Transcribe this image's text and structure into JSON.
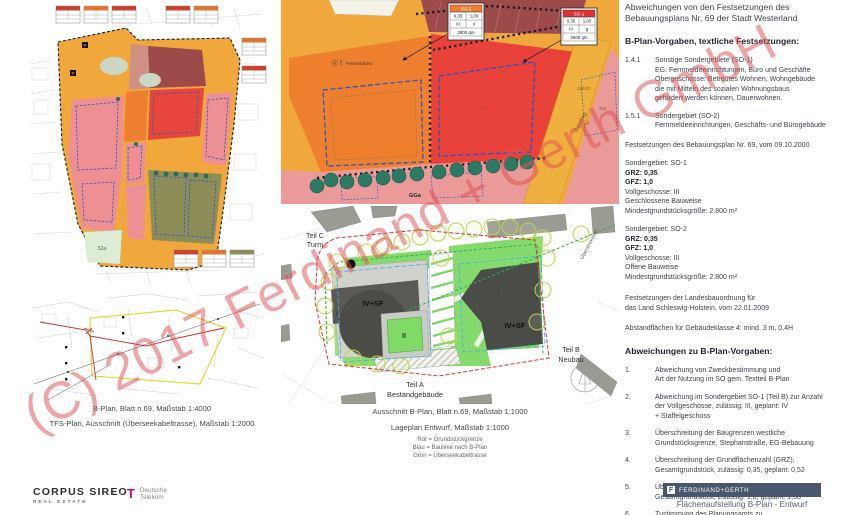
{
  "watermark": "(C) 2017 Ferdinand + Gerth GmbH",
  "colors": {
    "zone_yellow": "#f0a83c",
    "zone_orange": "#ee7f2e",
    "zone_red": "#e8453c",
    "zone_darkred": "#9c4a4a",
    "zone_pink": "#ee9093",
    "zone_olive": "#8d8d5a",
    "tree_teal": "#2c7a63",
    "site_green": "#85da6e",
    "building_gray": "#55554f",
    "dash_red": "#e03030",
    "dash_blue": "#44aaee",
    "dash_green": "#2db04a",
    "logo_bar_blue": "#49566e",
    "telekom_magenta": "#e20074"
  },
  "maps": {
    "overview": {
      "caption": "B-Plan, Blatt n.69, Maßstab 1:4000",
      "label_52a": "52a",
      "p_label": "P"
    },
    "tfs": {
      "caption": "TFS-Plan, Ausschnitt (Überseekabeltrasse), Maßstab 1:2000"
    },
    "detail": {
      "caption": "Ausschnitt B-Plan, Blatt n.69, Maßstab 1:1000",
      "so2_box": {
        "title": "SO-2",
        "r1c1": "0,35",
        "r1c2": "1,00",
        "r2c1": "III",
        "r2c2": "o",
        "r3": "2800 qm"
      },
      "so1_box": {
        "title": "SO-1",
        "r1c1": "0,35",
        "r1c2": "1,00",
        "r2c1": "III",
        "r2c2": "g",
        "r3": "2800 qm"
      },
      "fernsehturm": "Fernsehturm",
      "gga": "GGa",
      "parcel_333": "333",
      "bahnweg": "Bahnweg",
      "parcel_150": "150/22",
      "parcel_344": "344"
    },
    "siteplan": {
      "caption": "Lageplan Entwurf, Maßstab 1:1000",
      "legend": "Rot = Grundstückgrenze\nBlau = Baulinie nach B-Plan\nGrün = Überseekabeltrasse",
      "teil_c1": "Teil C",
      "teil_c2": "Turm",
      "teil_a1": "Teil A",
      "teil_a2": "Bestandgebäude",
      "teil_b1": "Teil B",
      "teil_b2": "Neubau",
      "floors_left": "IV+SF",
      "floors_right": "IV+SF",
      "label_I_left": "I",
      "label_II": "II",
      "label_I_right": "I",
      "cable": "Überseekabel"
    }
  },
  "rp": {
    "title": "Abweichungen von den Festsetzungen des Bebauungsplans Nr. 69 der Stadt Westerland",
    "h1": "B-Plan-Vorgaben, textliche Festsetzungen:",
    "items1": [
      {
        "num": "1.4.1",
        "text": "Sonstige Sondergebiete (SO-1)\nEG: Fernmeldeeinrichtungen, Büro und Geschäfte\nObergeschosse: Betreutes Wohnen, Wohngebäude\ndie mit Mitteln des sozialen Wohnungsbaus\ngefördert werden können, Dauerwohnen."
      },
      {
        "num": "1.5.1",
        "text": "Sondergebiet (SO-2)\nFernmeldeeinrichtungen, Geschäfts- und Bürogebäude"
      }
    ],
    "note1": "Festsetzungen des Bebauungsplan Nr. 69, vom 09.10.2000",
    "so1": {
      "t": "Sondergebiet: SO-1",
      "grz": "GRZ: 0,35",
      "gfz": "GFZ: 1,0",
      "rest": "Vollgeschosse: III\nGeschlossene Bauweise\nMindestgrundstücksgröße: 2.800 m²"
    },
    "so2": {
      "t": "Sondergebiet: SO-2",
      "grz": "GRZ: 0,35",
      "gfz": "GFZ: 1,0",
      "rest": "Vollgeschosse: III\nOffene Bauweise\nMindestgrundstücksgröße: 2.800 m²"
    },
    "note2": "Festsetzungen der Landesbauordnung für\ndas Land Schleswig-Holstein, vom 22.01.2009",
    "note3": "Abstandflächen für Gebäudeklasse 4: mind. 3 m, 0,4H",
    "h2": "Abweichungen zu B-Plan-Vorgaben:",
    "items2": [
      {
        "num": "1.",
        "text": "Abweichung von Zweckbestimmung und\nArt der Nutzung im SO gem. Textteil B-Plan"
      },
      {
        "num": "2.",
        "text": "Abweichung im Sondergebiet SO-1 (Teil B) zur Anzahl\nder Vollgeschosse, zulässig: III, geplant: IV\n+ Staffelgeschoss"
      },
      {
        "num": "3.",
        "text": "Überschreitung der Baugrenzen westliche\nGrundstücksgrenze, Stephanstraße, EG-Bebauung"
      },
      {
        "num": "4.",
        "text": "Überschreitung der Grundflächenzahl (GRZ),\nGesamtgrundstück, zulässig: 0,35, geplant: 0,52"
      },
      {
        "num": "5.",
        "text": "Überschreitung der Geschossflächenzahl (GFZ),\nGesamtgrundstück, zulässig: 1,0, geplant: 1,38"
      },
      {
        "num": "6.",
        "text": "Zustimmung des Planungsamts zu\nAbstandsflächen auf öffentlichem Straßenland"
      }
    ]
  },
  "footer": {
    "corpus_line1": "CORPUS SIREO",
    "corpus_line2": "REAL ESTATE",
    "telekom_t": "T",
    "telekom_dots": "▪ ▪",
    "telekom_name": "Deutsche\nTelekom",
    "fg_logo_letter": "F",
    "fg_logo": "FERDINAND+GERTH",
    "sheet_title": "Flächenaufstellung B-Plan - Entwurf"
  }
}
